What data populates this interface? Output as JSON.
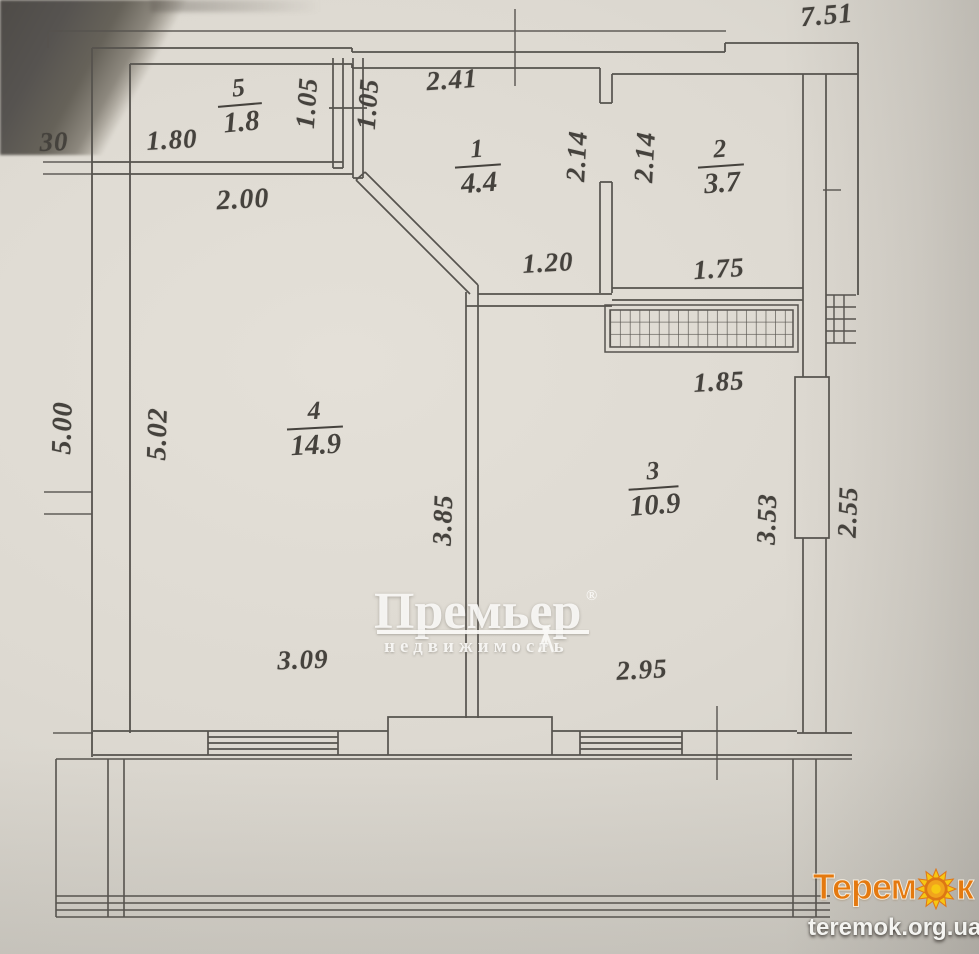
{
  "plan": {
    "rooms": [
      {
        "number": "5",
        "area": "1.8"
      },
      {
        "number": "1",
        "area": "4.4"
      },
      {
        "number": "2",
        "area": "3.7"
      },
      {
        "number": "4",
        "area": "14.9"
      },
      {
        "number": "3",
        "area": "10.9"
      }
    ],
    "dimensions": {
      "overall_width": "7.51",
      "left_wall_offset": "30",
      "room5_width": "1.80",
      "room5_depth": "1.05",
      "vent_shaft_depth": "1.05",
      "hall_width": "2.41",
      "hall_depth": "2.14",
      "room2_depth": "2.14",
      "room2_width": "1.75",
      "hall_opening": "1.20",
      "corridor_width": "2.00",
      "left_side_outer": "5.00",
      "left_side_inner": "5.02",
      "partition_length": "3.85",
      "loggia_grill_width": "1.85",
      "room3_depth": "3.53",
      "right_side": "2.55",
      "room4_bottom": "3.09",
      "room3_bottom": "2.95"
    }
  },
  "watermark": {
    "brand": "Премьер",
    "registered": "®",
    "subtitle": "недвижимость"
  },
  "footer": {
    "logo_part1": "Терем",
    "logo_part2": "к",
    "website": "teremok.org.ua"
  }
}
